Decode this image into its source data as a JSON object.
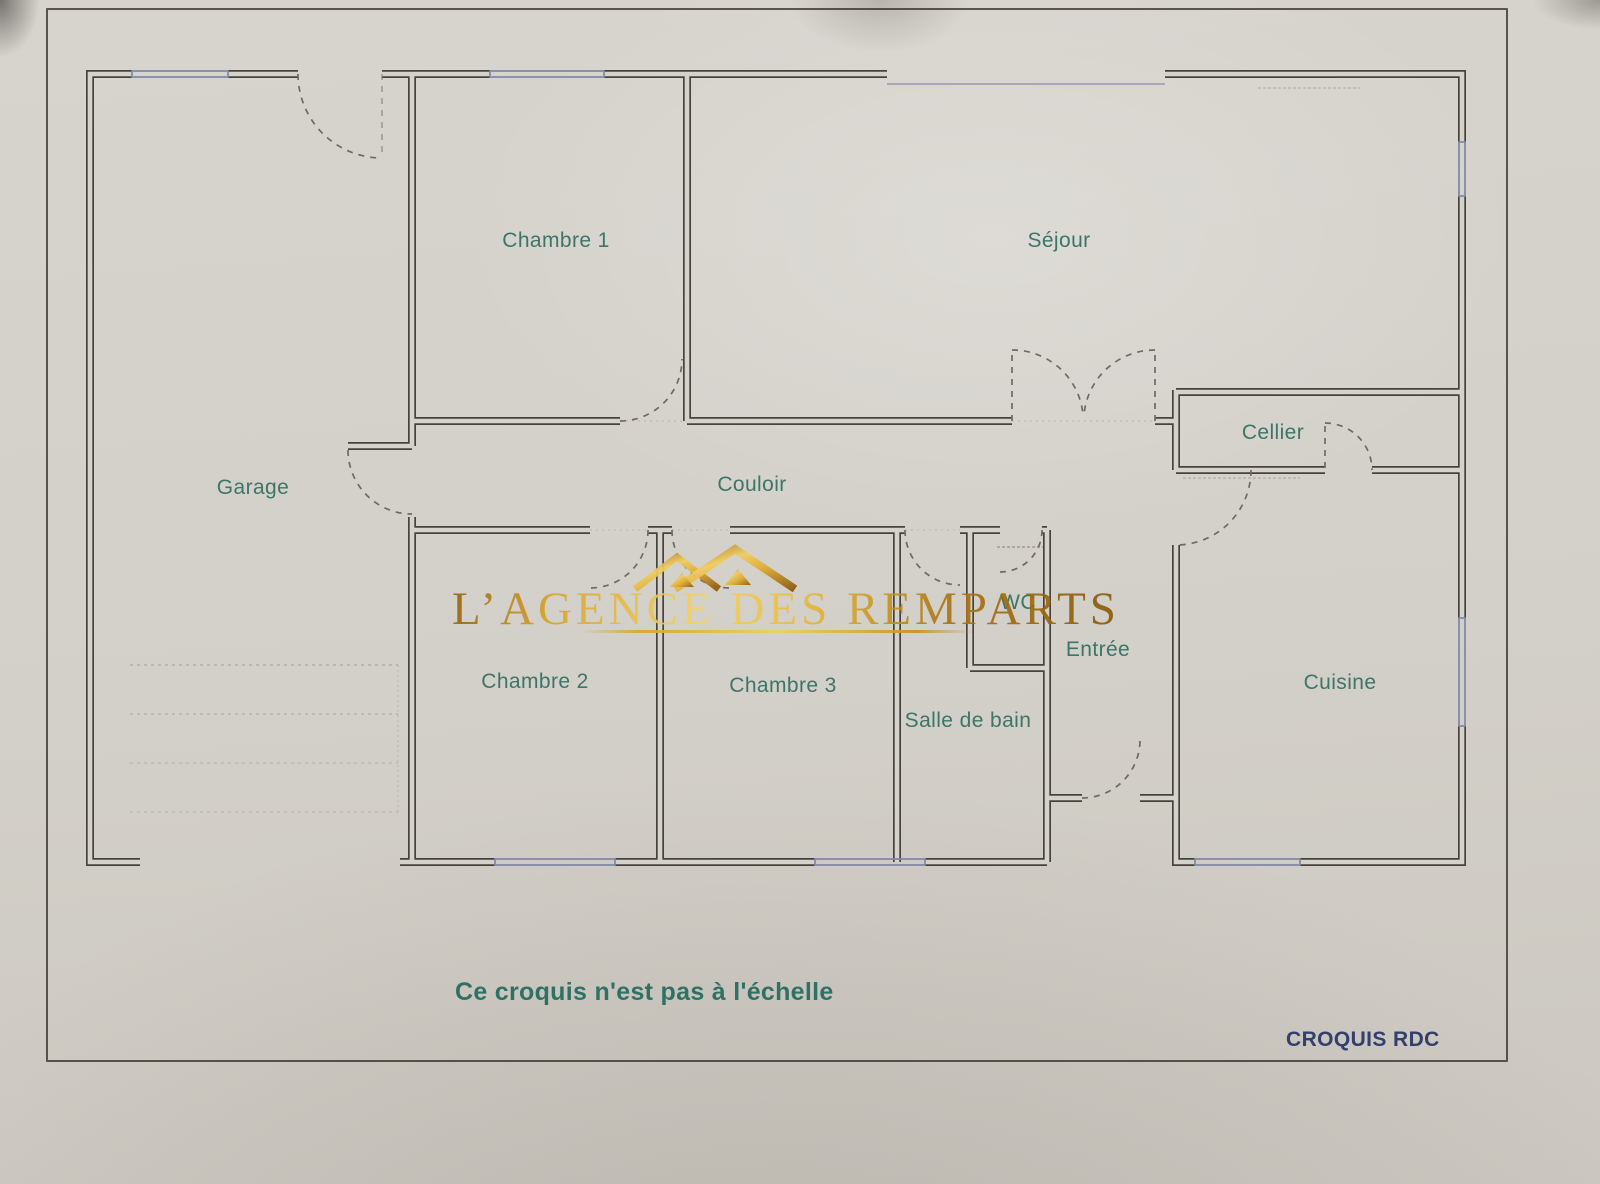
{
  "watermark": {
    "text": "L’AGENCE DES REMPARTS"
  },
  "plan": {
    "rooms": [
      {
        "id": "chambre-1",
        "label": "Chambre 1",
        "x": 556,
        "y": 241
      },
      {
        "id": "sejour",
        "label": "Séjour",
        "x": 1059,
        "y": 241
      },
      {
        "id": "garage",
        "label": "Garage",
        "x": 253,
        "y": 488
      },
      {
        "id": "couloir",
        "label": "Couloir",
        "x": 752,
        "y": 485
      },
      {
        "id": "cellier",
        "label": "Cellier",
        "x": 1273,
        "y": 433
      },
      {
        "id": "chambre-2",
        "label": "Chambre 2",
        "x": 535,
        "y": 682
      },
      {
        "id": "chambre-3",
        "label": "Chambre 3",
        "x": 783,
        "y": 686
      },
      {
        "id": "wc",
        "label": "WC",
        "x": 1018,
        "y": 603
      },
      {
        "id": "entree",
        "label": "Entrée",
        "x": 1098,
        "y": 650
      },
      {
        "id": "salle-de-bain",
        "label": "Salle de bain",
        "x": 968,
        "y": 721
      },
      {
        "id": "cuisine",
        "label": "Cuisine",
        "x": 1340,
        "y": 683
      }
    ]
  },
  "footer": {
    "scale_note": "Ce croquis n'est pas à l'échelle",
    "plan_reference": "CROQUIS RDC"
  },
  "colors": {
    "wall": "#46423c",
    "window": "#7e86a8",
    "room_label": "#3d7569",
    "scale_note": "#2f7164",
    "plan_reference": "#333f6d",
    "watermark_gold": "#d9a62e"
  }
}
